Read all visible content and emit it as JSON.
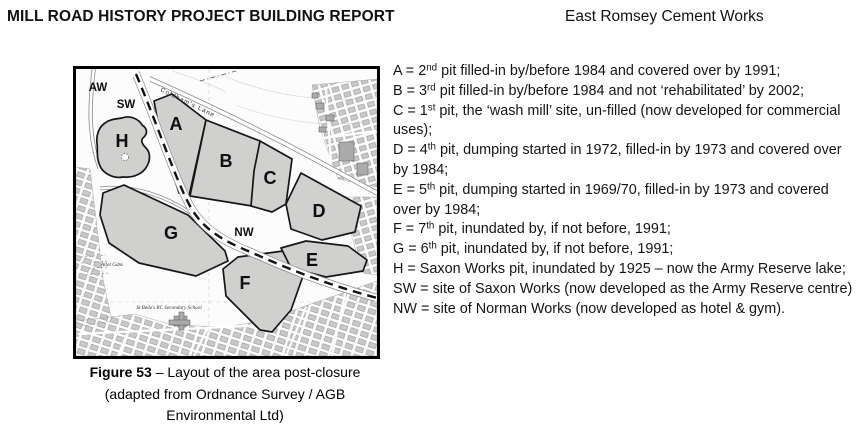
{
  "header": {
    "left_title": "MILL ROAD HISTORY PROJECT BUILDING REPORT",
    "right_title": "East Romsey Cement Works"
  },
  "figure": {
    "label": "Figure 53",
    "caption_rest": " – Layout of the area post-closure (adapted from Ordnance Survey / AGB Environmental Ltd)"
  },
  "map": {
    "labels": {
      "aw": "AW",
      "sw": "SW",
      "nw": "NW",
      "a": "A",
      "b": "B",
      "c": "C",
      "d": "D",
      "e": "E",
      "f": "F",
      "g": "G",
      "h": "H"
    },
    "texts": {
      "lane": "Coldham's Lane",
      "allot": "Allot Gdns",
      "school": "St Bede's RC Secondary School"
    },
    "colors": {
      "pit_fill": "#d0d0cf",
      "outline": "#161616",
      "building": "#ababab",
      "paper": "#fcfcfc"
    }
  },
  "legend": {
    "entries": [
      {
        "pre": "A = 2",
        "sup": "nd",
        "post": " pit filled-in by/before 1984 and covered over by 1991;"
      },
      {
        "pre": "B = 3",
        "sup": "rd",
        "post": " pit filled-in by/before 1984 and not ‘rehabilitated’ by 2002;"
      },
      {
        "pre": "C = 1",
        "sup": "st",
        "post": " pit, the ‘wash mill’ site, un-filled (now developed for commercial uses);"
      },
      {
        "pre": "D = 4",
        "sup": "th",
        "post": " pit, dumping started in 1972, filled-in by 1973 and covered over by 1984;"
      },
      {
        "pre": "E = 5",
        "sup": "th",
        "post": " pit, dumping started in 1969/70, filled-in by 1973 and covered over by 1984;"
      },
      {
        "pre": "F = 7",
        "sup": "th",
        "post": " pit, inundated by, if not before, 1991;"
      },
      {
        "pre": "G = 6",
        "sup": "th",
        "post": " pit, inundated by, if not before, 1991;"
      },
      {
        "pre": "H = Saxon Works pit, inundated by 1925 – now the Army Reserve lake;",
        "sup": "",
        "post": ""
      },
      {
        "pre": "SW = site of Saxon Works (now developed as the Army Reserve centre)",
        "sup": "",
        "post": ""
      },
      {
        "pre": "NW = site of Norman Works (now developed as hotel & gym).",
        "sup": "",
        "post": ""
      }
    ]
  }
}
